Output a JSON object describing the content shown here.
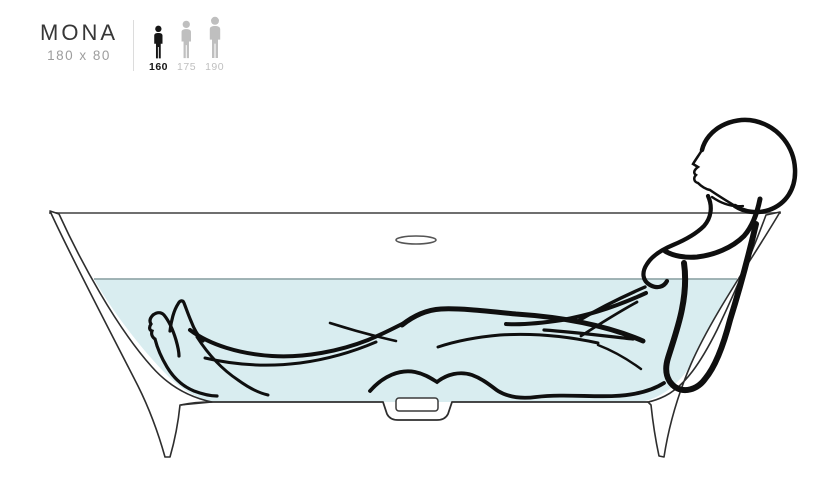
{
  "product": {
    "name": "MONA",
    "dimensions": "180 x 80"
  },
  "size_guide": {
    "options": [
      {
        "height_cm": "160",
        "selected": true
      },
      {
        "height_cm": "175",
        "selected": false
      },
      {
        "height_cm": "190",
        "selected": false
      }
    ]
  },
  "illustration": {
    "description": "Side cross-section line drawing of the MONA freestanding bathtub with a bather reclining in water, feet raised at the left and head resting above the rim at the right",
    "colors": {
      "water": "#d9edf0",
      "waterline": "#94a9ab",
      "tub_outline": "#2e2e2e",
      "rim_line": "#6f6f6f",
      "figure_line": "#0f0f0f",
      "selected_black": "#161616",
      "unselected_gray": "#bfbfbf"
    }
  }
}
